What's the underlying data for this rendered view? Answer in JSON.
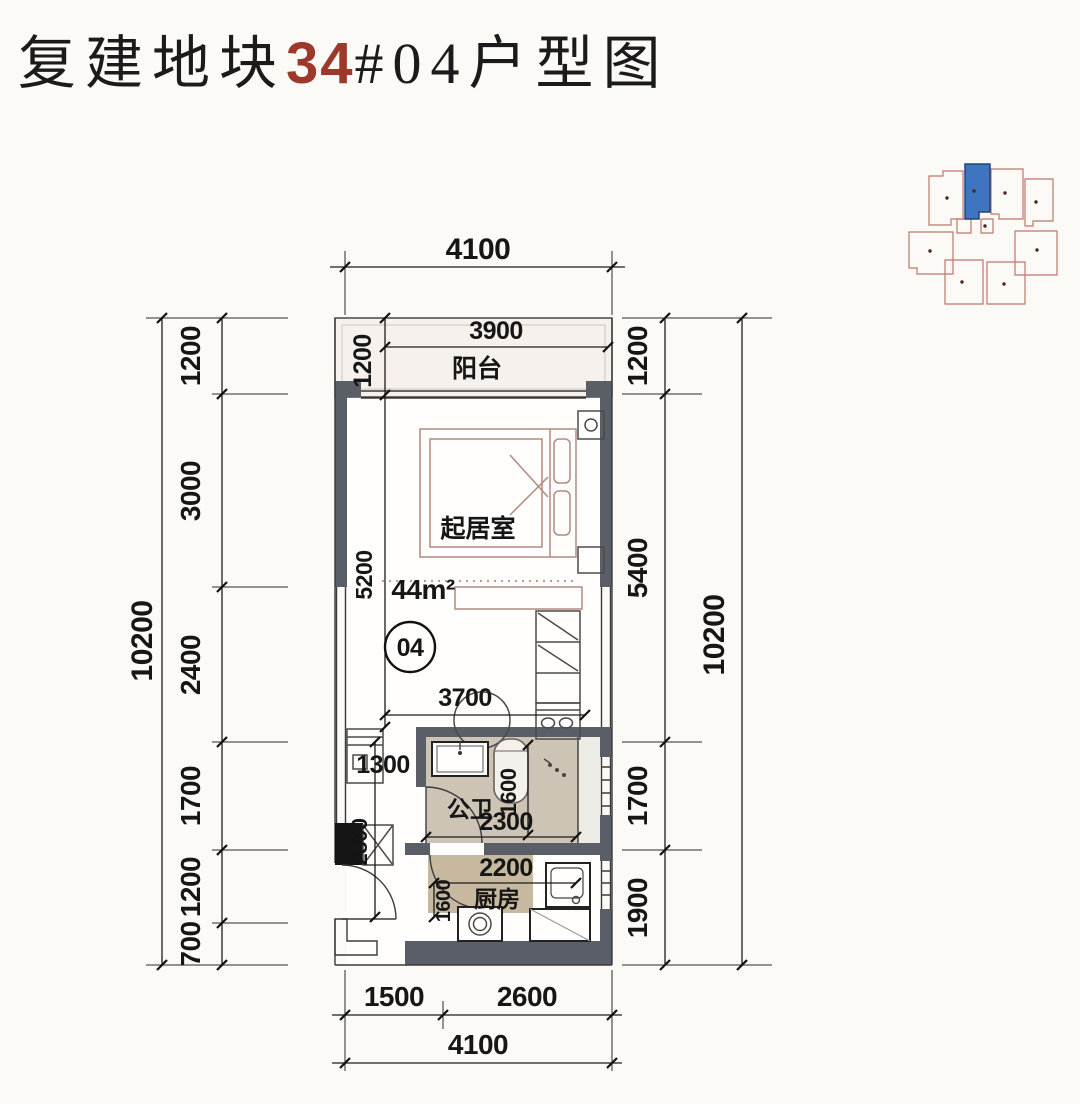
{
  "title": {
    "prefix": "复建地块",
    "block_no": "34",
    "suffix": "#04户型图"
  },
  "colors": {
    "accent_red": "#9d392b",
    "wall_gray": "#5a5e66",
    "keyplan_highlight": "#3f74c0",
    "keyplan_highlight_border": "#23457e",
    "keyplan_outline": "#c0766a",
    "bath_floor_tan": "#cdc4b5",
    "kitchen_floor_tan": "#c6b9a0"
  },
  "plan": {
    "area_label": "44m²",
    "unit_number": "04",
    "rooms": {
      "balcony": "阳台",
      "living": "起居室",
      "bathroom": "公卫",
      "kitchen": "厨房"
    }
  },
  "dimensions": {
    "top_overall": "4100",
    "balcony_width": "3900",
    "balcony_depth": "1200",
    "living_depth": "5200",
    "living_width": "3700",
    "left_overall": "10200",
    "left_segments": [
      "1200",
      "3000",
      "2400",
      "1700",
      "1200",
      "700"
    ],
    "right_overall": "10200",
    "right_segments": [
      "1200",
      "5400",
      "1700",
      "1900"
    ],
    "bottom_left": "1500",
    "bottom_right": "2600",
    "bottom_overall": "4100",
    "hall_width": "1300",
    "hall_depth": "2800",
    "bath_width": "2300",
    "bath_depth": "1600",
    "kitchen_width": "2200",
    "kitchen_side": "1600"
  }
}
